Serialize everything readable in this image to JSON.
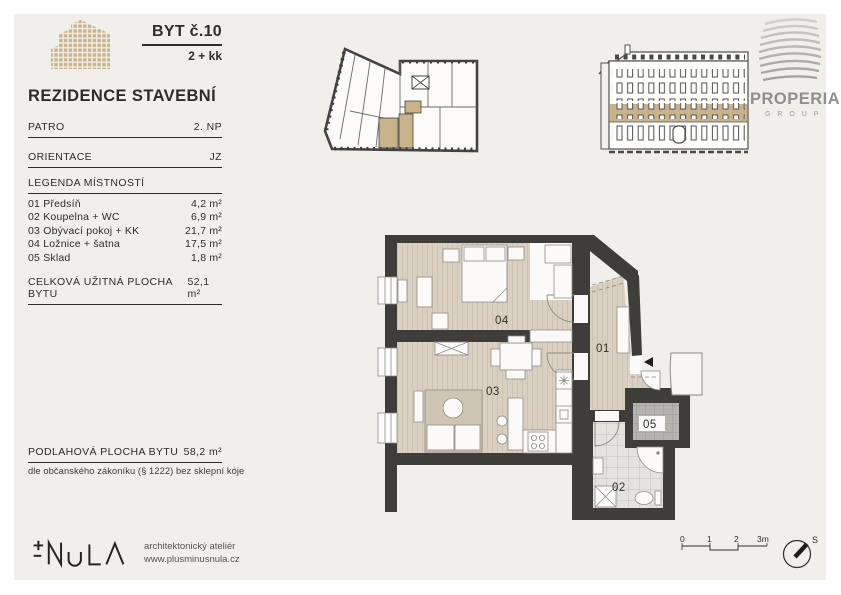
{
  "header": {
    "unit_label": "BYT č.10",
    "layout": "2 + kk",
    "project": "REZIDENCE STAVEBNÍ"
  },
  "info": {
    "floor_label": "PATRO",
    "floor_value": "2. NP",
    "orientation_label": "ORIENTACE",
    "orientation_value": "JZ"
  },
  "legend": {
    "title": "LEGENDA MÍSTNOSTÍ",
    "rooms": [
      {
        "name": "01 Předsíň",
        "area": "4,2 m²"
      },
      {
        "name": "02 Koupelna + WC",
        "area": "6,9 m²"
      },
      {
        "name": "03 Obývací pokoj + KK",
        "area": "21,7 m²"
      },
      {
        "name": "04 Ložnice + šatna",
        "area": "17,5 m²"
      },
      {
        "name": "05 Sklad",
        "area": "1,8 m²"
      }
    ],
    "total_label": "CELKOVÁ UŽITNÁ PLOCHA BYTU",
    "total_value": "52,1 m²"
  },
  "floor_area": {
    "label": "PODLAHOVÁ PLOCHA BYTU",
    "value": "58,2 m²",
    "note": "dle občanského zákoníku (§ 1222) bez sklepní kóje"
  },
  "studio": {
    "line1": "architektonický ateliér",
    "line2": "www.plusminusnula.cz"
  },
  "brand": {
    "name": "PROPERIA",
    "sub": "G R O U P"
  },
  "plan": {
    "r01": "01",
    "r02": "02",
    "r03": "03",
    "r04": "04",
    "r05": "05"
  },
  "scalebar": {
    "t0": "0",
    "t1": "1",
    "t2": "2",
    "t3": "3m"
  },
  "compass": {
    "north": "S"
  },
  "colors": {
    "accent_tan": "#c9b287",
    "wall": "#3e3d3a",
    "background": "#f1efe9"
  }
}
